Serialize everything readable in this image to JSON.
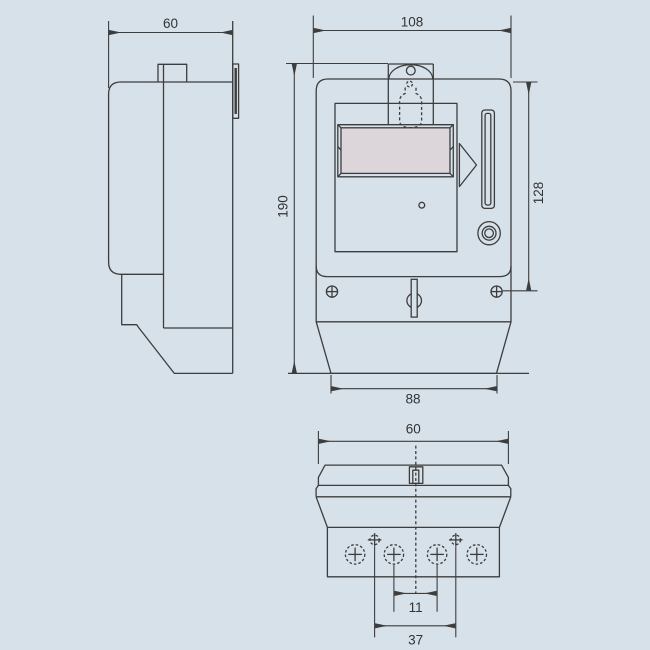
{
  "colors": {
    "background": "#d7e1ea",
    "line": "#3d3d3d",
    "display_fill": "#dcd6db",
    "label_text": "#333333"
  },
  "dimensions": {
    "side_view": {
      "depth": "60"
    },
    "front_view": {
      "width": "108",
      "height": "190",
      "mounting_height": "128",
      "mounting_width": "88"
    },
    "bottom_view": {
      "width": "60",
      "terminal_pitch": "11",
      "fixing_screw_span": "37"
    }
  }
}
